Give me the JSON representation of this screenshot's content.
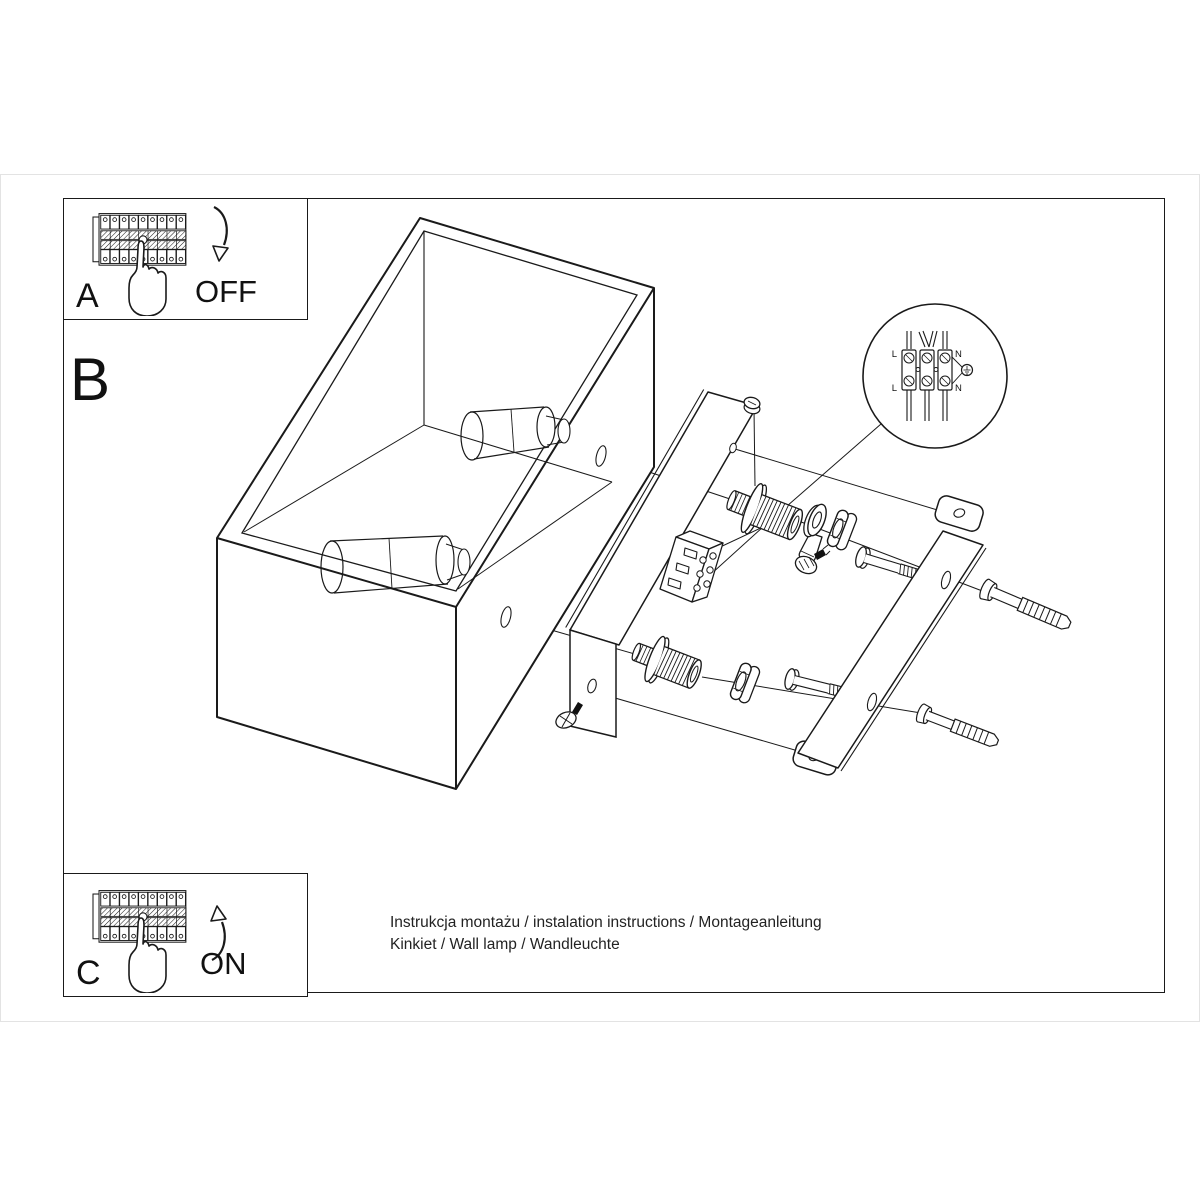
{
  "colors": {
    "ink": "#1a1a1a",
    "paper": "#ffffff",
    "sheet_edge": "#e3e3e3"
  },
  "panels": {
    "a": {
      "label": "A",
      "action": "OFF"
    },
    "b": {
      "label": "B"
    },
    "c": {
      "label": "C",
      "action": "ON"
    }
  },
  "wiring_detail": {
    "labels": {
      "top_left": "L",
      "top_right": "N",
      "bottom_left": "L",
      "bottom_right": "N"
    }
  },
  "caption": {
    "line1": "Instrukcja montażu / instalation instructions / Montageanleitung",
    "line2": "Kinkiet / Wall lamp / Wandleuchte"
  }
}
